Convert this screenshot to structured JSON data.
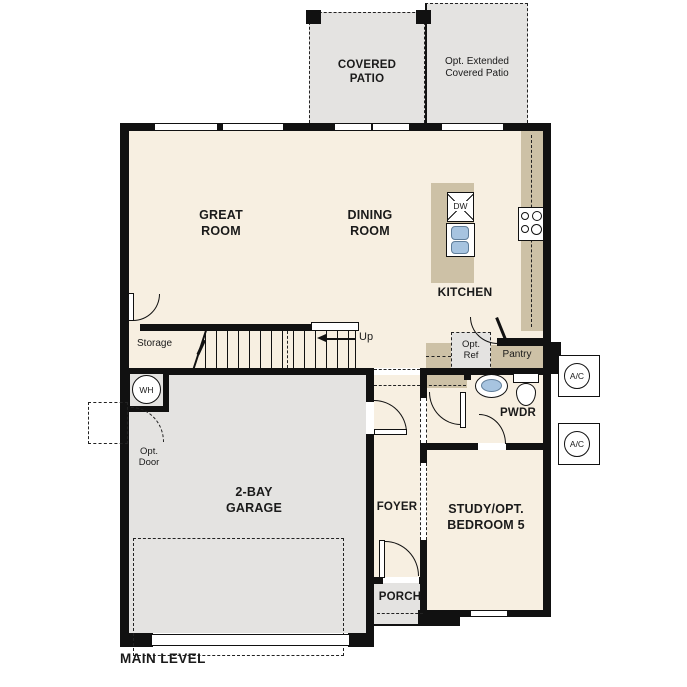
{
  "plan": {
    "title": "MAIN LEVEL",
    "rooms": {
      "covered_patio": "COVERED PATIO",
      "extended_patio": "Opt. Extended Covered Patio",
      "great_room": "GREAT ROOM",
      "dining_room": "DINING ROOM",
      "kitchen": "KITCHEN",
      "storage": "Storage",
      "pantry": "Pantry",
      "powder_room": "PWDR",
      "foyer": "FOYER",
      "porch": "PORCH",
      "garage": "2-BAY GARAGE",
      "study": "STUDY/OPT. BEDROOM 5"
    },
    "annotations": {
      "stairs_up": "Up",
      "opt_ref": "Opt. Ref",
      "opt_door": "Opt. Door",
      "water_heater": "WH",
      "ac_unit": "A/C",
      "dishwasher": "DW"
    },
    "colors": {
      "floor": "#f7efe1",
      "hardscape": "#e4e3e1",
      "counter": "#cdc1a6",
      "fixture_blue": "#a7c4e0",
      "wall": "#111111"
    }
  }
}
